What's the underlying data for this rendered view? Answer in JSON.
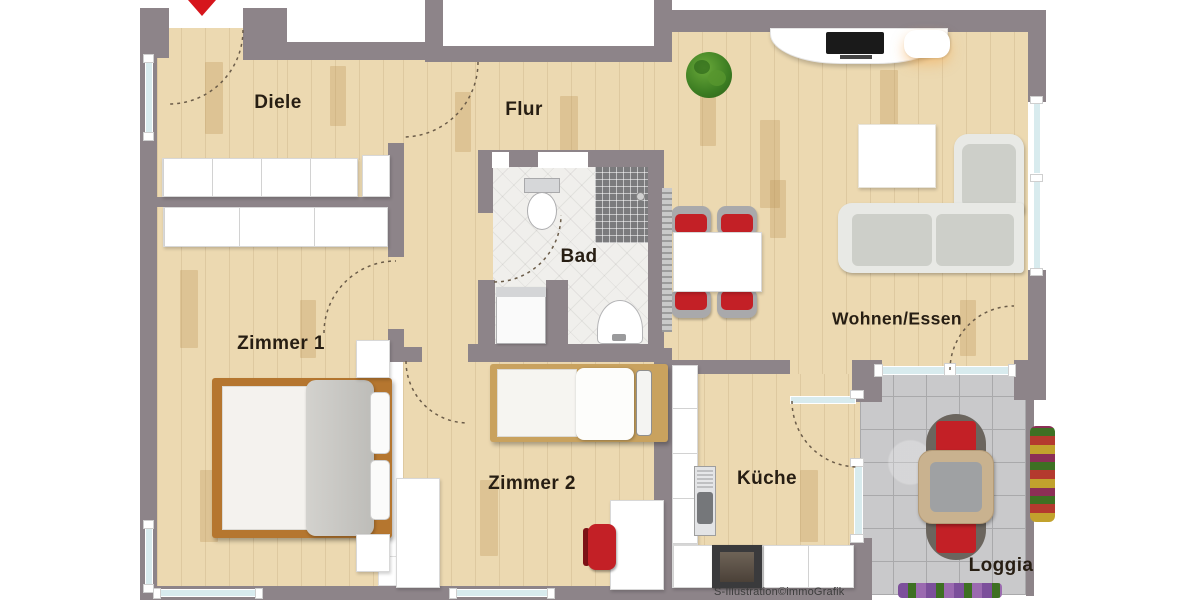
{
  "title": "Wohnung Grundriss",
  "rooms": {
    "diele": "Diele",
    "flur": "Flur",
    "bad": "Bad",
    "zimmer1": "Zimmer 1",
    "zimmer2": "Zimmer 2",
    "kueche": "Küche",
    "wohnen_essen": "Wohnen/Essen",
    "loggia": "Loggia"
  },
  "watermark": {
    "logo": "Ṡ",
    "text": "-Illustration©immoGrafik"
  },
  "colors": {
    "wall": "#8d8489",
    "wood_floor": "#ecd9b1",
    "bath_tile": "#f0efec",
    "loggia_tile": "#c9c9cb",
    "glazing": "#d8ebee",
    "accent_red": "#c32026",
    "entrance_arrow": "#d6151c"
  }
}
